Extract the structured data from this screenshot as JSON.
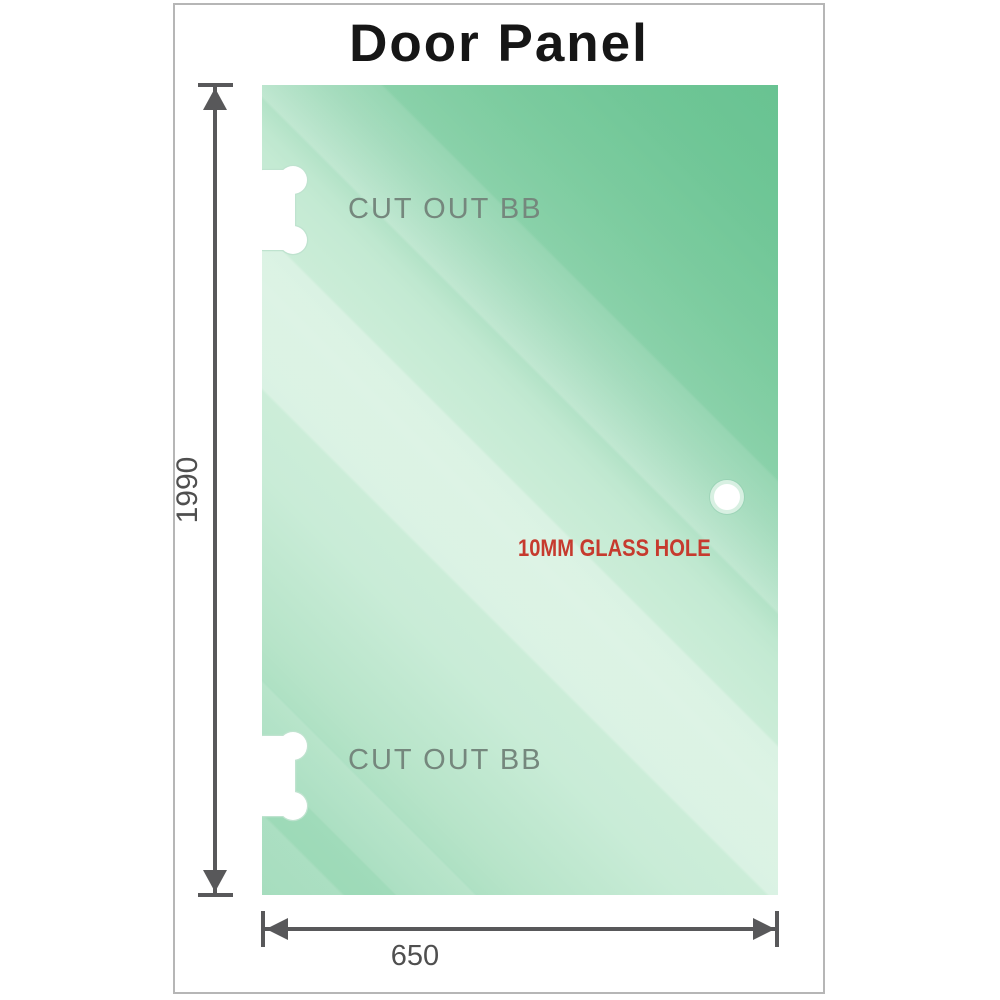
{
  "diagram": {
    "title": "Door Panel",
    "panel": {
      "cutout_top_label": "CUT OUT BB",
      "cutout_bottom_label": "CUT OUT BB",
      "hole_label": "10MM GLASS HOLE"
    },
    "dimensions": {
      "height_mm": "1990",
      "width_mm": "650"
    },
    "colors": {
      "glass_light": "#d0efdb",
      "glass_mid": "#9ad8b5",
      "glass_dark": "#70c798",
      "hole_label_red": "#c63a2e",
      "dimension_gray": "#58585a",
      "cutout_label_gray": "#75877d",
      "frame_border_gray": "#b6b6b6",
      "title_black": "#161616"
    }
  }
}
